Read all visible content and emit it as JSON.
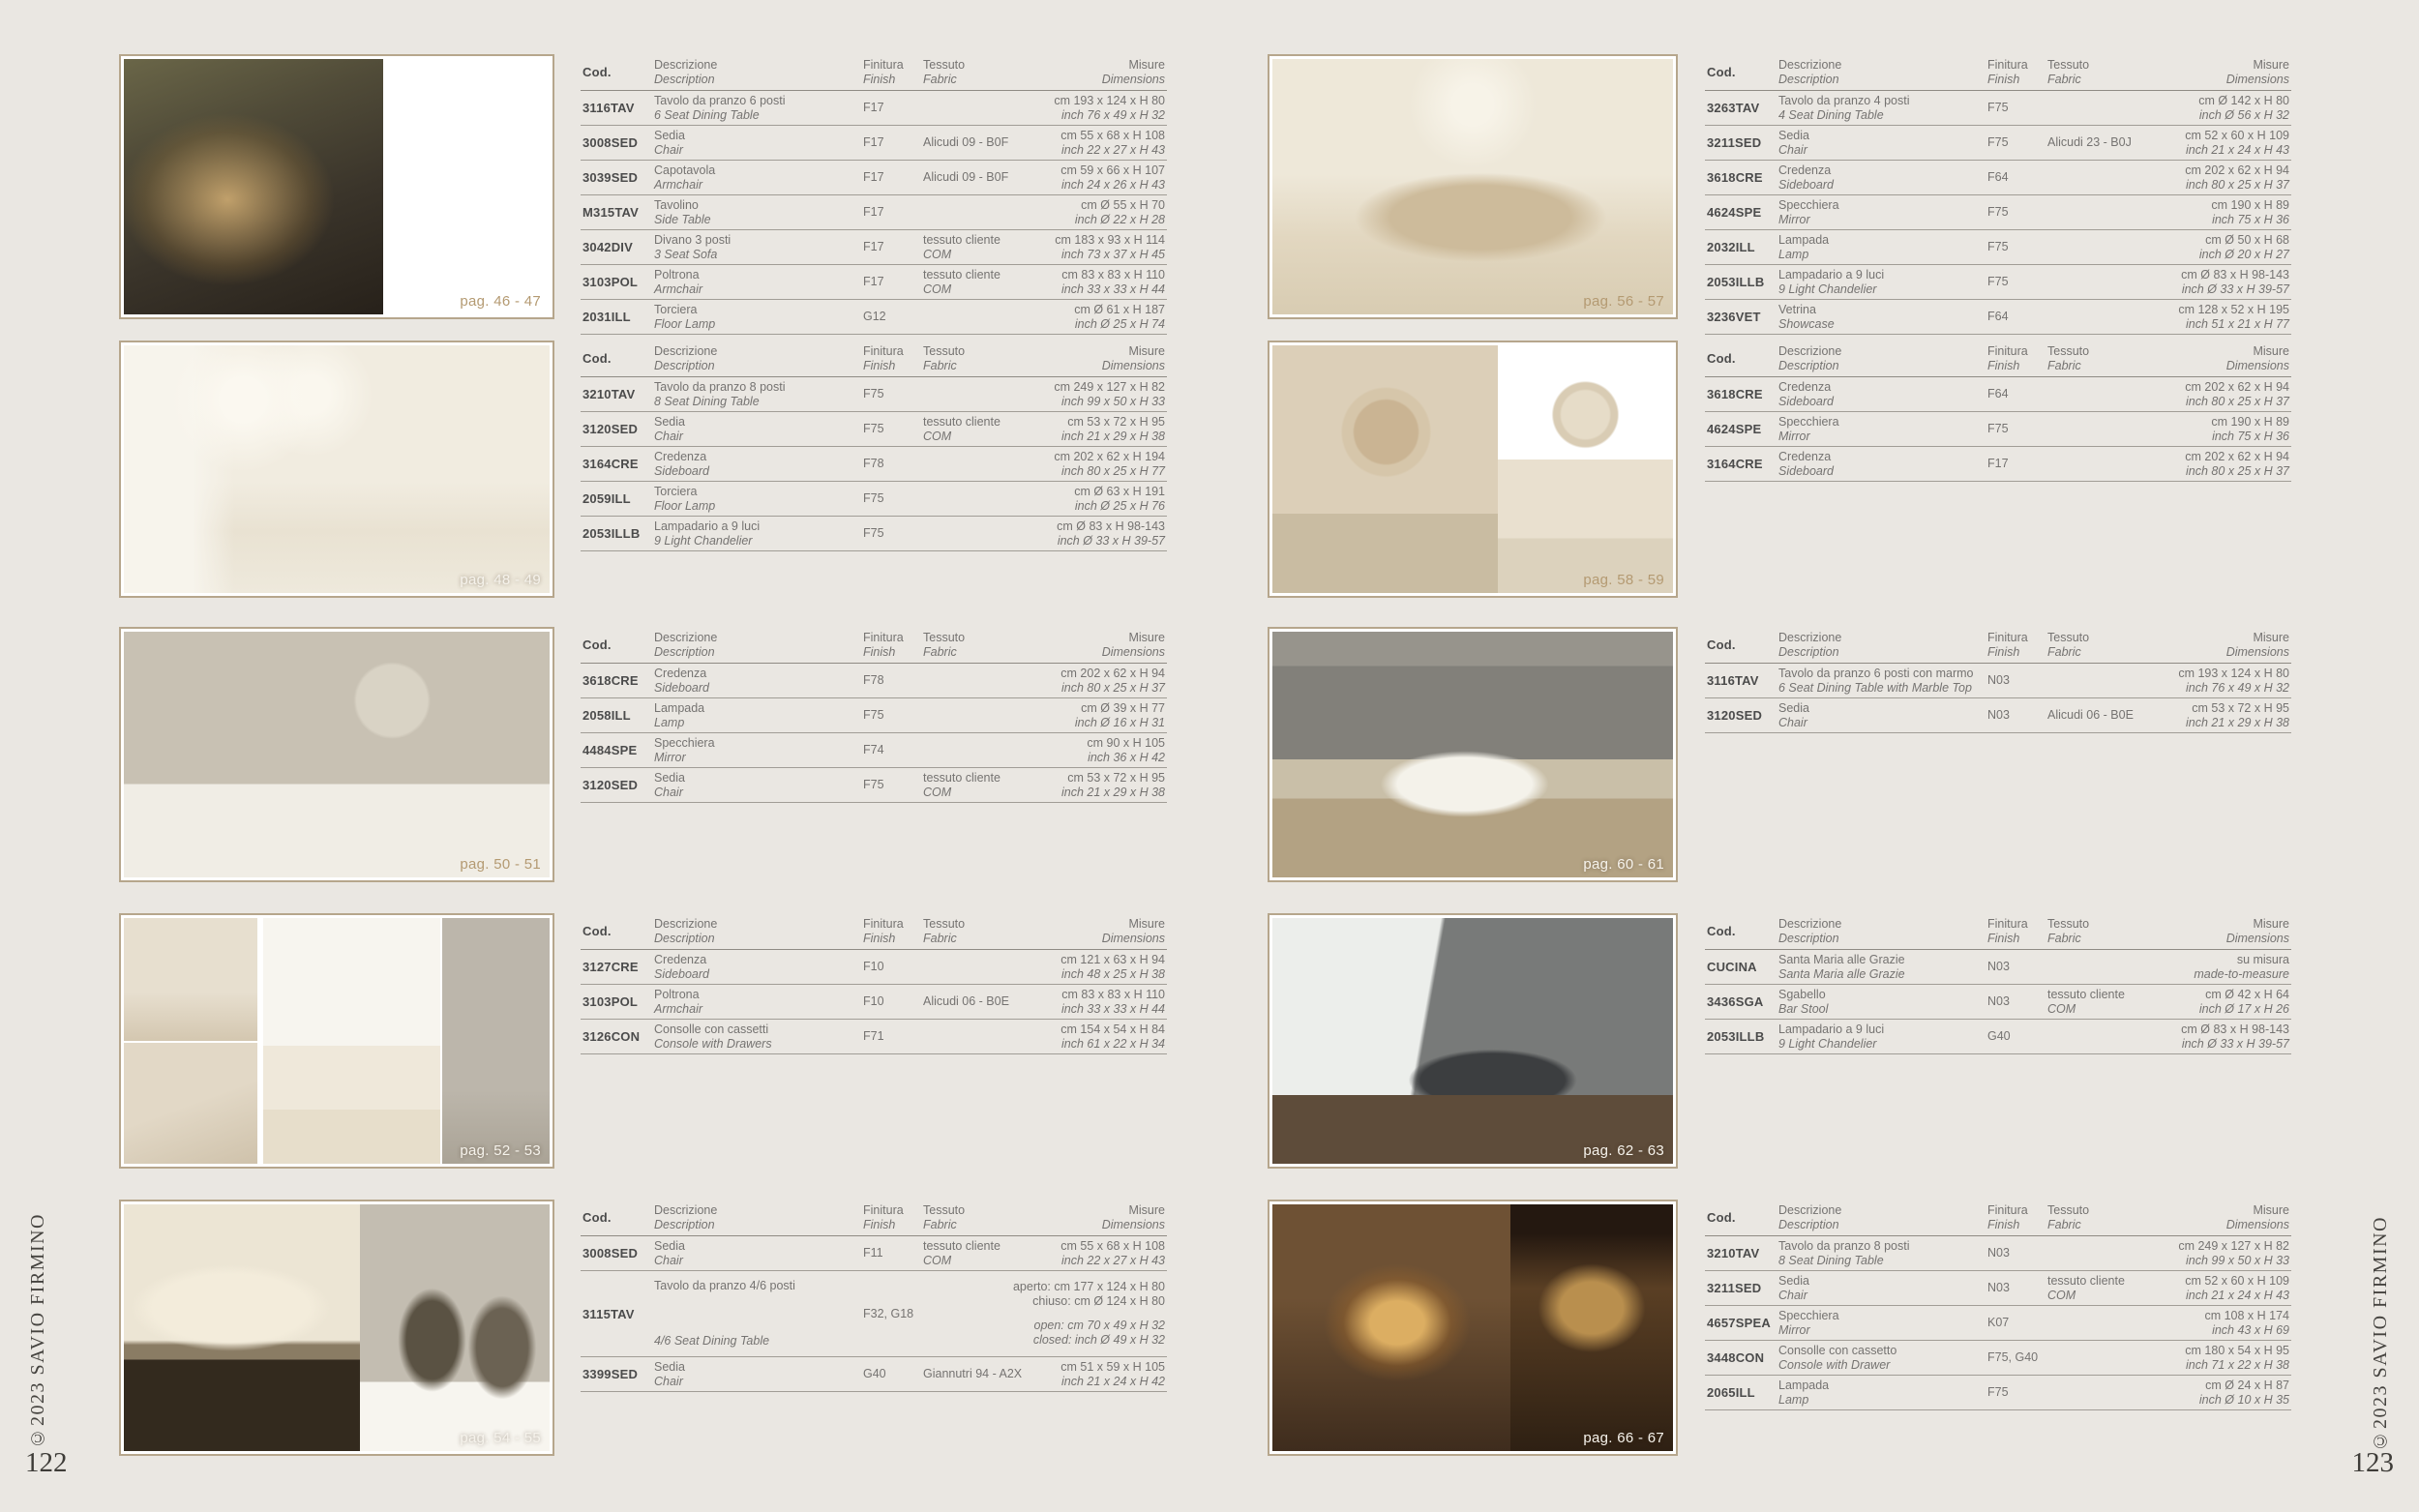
{
  "colors": {
    "page_bg": "#eae7e2",
    "accent_tan": "#b49a72",
    "table_text": "#757371",
    "code_text": "#4b4b4b",
    "divider": "#a19d96",
    "photo_border": "#b6a68c"
  },
  "table_headers": {
    "code": "Cod.",
    "desc_it": "Descrizione",
    "desc_en": "Description",
    "fin_it": "Finitura",
    "fin_en": "Finish",
    "fab_it": "Tessuto",
    "fab_en": "Fabric",
    "mis_it": "Misure",
    "mis_en": "Dimensions"
  },
  "left_page": {
    "page_number": "122",
    "copyright": "©2023 SAVIO FIRMINO",
    "photo_labels": [
      "pag. 46 - 47",
      "pag. 48 - 49",
      "pag. 50 - 51",
      "pag. 52 - 53",
      "pag. 54 - 55"
    ],
    "tables": [
      {
        "rows": [
          {
            "code": "3116TAV",
            "desc_it": "Tavolo da pranzo 6 posti",
            "desc_en": "6 Seat Dining Table",
            "finish": "F17",
            "fabric": null,
            "dims_plain": [
              "cm 193 x 124 x H 80"
            ],
            "dims_italic": [
              "inch 76 x 49 x H 32"
            ]
          },
          {
            "code": "3008SED",
            "desc_it": "Sedia",
            "desc_en": "Chair",
            "finish": "F17",
            "fabric": {
              "l1": "Alicudi 09 - B0F"
            },
            "dims_plain": [
              "cm 55 x 68 x H 108"
            ],
            "dims_italic": [
              "inch 22 x 27 x H 43"
            ]
          },
          {
            "code": "3039SED",
            "desc_it": "Capotavola",
            "desc_en": "Armchair",
            "finish": "F17",
            "fabric": {
              "l1": "Alicudi 09 - B0F"
            },
            "dims_plain": [
              "cm 59 x 66 x H 107"
            ],
            "dims_italic": [
              "inch 24 x 26 x H 43"
            ]
          },
          {
            "code": "M315TAV",
            "desc_it": "Tavolino",
            "desc_en": "Side Table",
            "finish": "F17",
            "fabric": null,
            "dims_plain": [
              "cm Ø 55 x H 70"
            ],
            "dims_italic": [
              "inch Ø 22 x H 28"
            ]
          },
          {
            "code": "3042DIV",
            "desc_it": "Divano 3 posti",
            "desc_en": "3 Seat Sofa",
            "finish": "F17",
            "fabric": {
              "l1": "tessuto cliente",
              "l2": "COM"
            },
            "dims_plain": [
              "cm 183 x 93 x H 114"
            ],
            "dims_italic": [
              "inch 73 x 37 x H 45"
            ]
          },
          {
            "code": "3103POL",
            "desc_it": "Poltrona",
            "desc_en": "Armchair",
            "finish": "F17",
            "fabric": {
              "l1": "tessuto cliente",
              "l2": "COM"
            },
            "dims_plain": [
              "cm 83 x 83 x H 110"
            ],
            "dims_italic": [
              "inch 33 x 33 x H 44"
            ]
          },
          {
            "code": "2031ILL",
            "desc_it": "Torciera",
            "desc_en": "Floor Lamp",
            "finish": "G12",
            "fabric": null,
            "dims_plain": [
              "cm Ø 61 x H 187"
            ],
            "dims_italic": [
              "inch Ø 25 x H 74"
            ]
          }
        ]
      },
      {
        "rows": [
          {
            "code": "3210TAV",
            "desc_it": "Tavolo da pranzo 8 posti",
            "desc_en": "8 Seat Dining Table",
            "finish": "F75",
            "fabric": null,
            "dims_plain": [
              "cm 249 x 127 x H 82"
            ],
            "dims_italic": [
              "inch 99 x 50 x H 33"
            ]
          },
          {
            "code": "3120SED",
            "desc_it": "Sedia",
            "desc_en": "Chair",
            "finish": "F75",
            "fabric": {
              "l1": "tessuto cliente",
              "l2": "COM"
            },
            "dims_plain": [
              "cm 53 x 72 x H 95"
            ],
            "dims_italic": [
              "inch 21 x 29 x H 38"
            ]
          },
          {
            "code": "3164CRE",
            "desc_it": "Credenza",
            "desc_en": "Sideboard",
            "finish": "F78",
            "fabric": null,
            "dims_plain": [
              "cm 202 x 62 x H 194"
            ],
            "dims_italic": [
              "inch 80 x 25 x H 77"
            ]
          },
          {
            "code": "2059ILL",
            "desc_it": "Torciera",
            "desc_en": "Floor Lamp",
            "finish": "F75",
            "fabric": null,
            "dims_plain": [
              "cm Ø 63 x H 191"
            ],
            "dims_italic": [
              "inch Ø 25 x H 76"
            ]
          },
          {
            "code": "2053ILLB",
            "desc_it": "Lampadario a 9 luci",
            "desc_en": "9 Light Chandelier",
            "finish": "F75",
            "fabric": null,
            "dims_plain": [
              "cm Ø 83 x H 98-143"
            ],
            "dims_italic": [
              "inch Ø 33 x H 39-57"
            ]
          }
        ]
      },
      {
        "rows": [
          {
            "code": "3618CRE",
            "desc_it": "Credenza",
            "desc_en": "Sideboard",
            "finish": "F78",
            "fabric": null,
            "dims_plain": [
              "cm 202 x 62 x H 94"
            ],
            "dims_italic": [
              "inch 80 x 25 x H 37"
            ]
          },
          {
            "code": "2058ILL",
            "desc_it": "Lampada",
            "desc_en": "Lamp",
            "finish": "F75",
            "fabric": null,
            "dims_plain": [
              "cm Ø 39 x H 77"
            ],
            "dims_italic": [
              "inch Ø 16 x H 31"
            ]
          },
          {
            "code": "4484SPE",
            "desc_it": "Specchiera",
            "desc_en": "Mirror",
            "finish": "F74",
            "fabric": null,
            "dims_plain": [
              "cm 90 x H 105"
            ],
            "dims_italic": [
              "inch 36 x H 42"
            ]
          },
          {
            "code": "3120SED",
            "desc_it": "Sedia",
            "desc_en": "Chair",
            "finish": "F75",
            "fabric": {
              "l1": "tessuto cliente",
              "l2": "COM"
            },
            "dims_plain": [
              "cm 53 x 72 x H 95"
            ],
            "dims_italic": [
              "inch 21 x 29 x H 38"
            ]
          }
        ]
      },
      {
        "rows": [
          {
            "code": "3127CRE",
            "desc_it": "Credenza",
            "desc_en": "Sideboard",
            "finish": "F10",
            "fabric": null,
            "dims_plain": [
              "cm 121 x 63 x H 94"
            ],
            "dims_italic": [
              "inch 48 x 25 x H 38"
            ]
          },
          {
            "code": "3103POL",
            "desc_it": "Poltrona",
            "desc_en": "Armchair",
            "finish": "F10",
            "fabric": {
              "l1": "Alicudi 06 - B0E"
            },
            "dims_plain": [
              "cm 83 x 83 x H 110"
            ],
            "dims_italic": [
              "inch 33 x 33 x H 44"
            ]
          },
          {
            "code": "3126CON",
            "desc_it": "Consolle con cassetti",
            "desc_en": "Console with Drawers",
            "finish": "F71",
            "fabric": null,
            "dims_plain": [
              "cm 154 x 54 x H 84"
            ],
            "dims_italic": [
              "inch 61 x 22 x H 34"
            ]
          }
        ]
      },
      {
        "rows": [
          {
            "code": "3008SED",
            "desc_it": "Sedia",
            "desc_en": "Chair",
            "finish": "F11",
            "fabric": {
              "l1": "tessuto cliente",
              "l2": "COM"
            },
            "dims_plain": [
              "cm 55 x 68 x H 108"
            ],
            "dims_italic": [
              "inch 22 x 27 x H 43"
            ]
          },
          {
            "code": "3115TAV",
            "tall": true,
            "desc_it": "Tavolo da pranzo 4/6 posti",
            "desc_en": "4/6 Seat Dining Table",
            "finish": "F32, G18",
            "fabric": null,
            "dims_plain": [
              "aperto: cm 177 x 124 x H 80",
              "chiuso: cm Ø 124 x H 80"
            ],
            "dims_italic": [
              "open: cm 70 x 49 x H 32",
              "closed: inch Ø 49 x H 32"
            ]
          },
          {
            "code": "3399SED",
            "desc_it": "Sedia",
            "desc_en": "Chair",
            "finish": "G40",
            "fabric": {
              "l1": "Giannutri 94 - A2X"
            },
            "dims_plain": [
              "cm 51 x 59 x H 105"
            ],
            "dims_italic": [
              "inch 21 x 24 x H 42"
            ]
          }
        ]
      }
    ]
  },
  "right_page": {
    "page_number": "123",
    "copyright": "©2023 SAVIO FIRMINO",
    "photo_labels": [
      "pag. 56 - 57",
      "pag. 58 - 59",
      "pag. 60 - 61",
      "pag. 62 - 63",
      "pag. 66 - 67"
    ],
    "tables": [
      {
        "rows": [
          {
            "code": "3263TAV",
            "desc_it": "Tavolo da pranzo 4 posti",
            "desc_en": "4 Seat Dining Table",
            "finish": "F75",
            "fabric": null,
            "dims_plain": [
              "cm Ø 142 x H 80"
            ],
            "dims_italic": [
              "inch Ø 56 x H 32"
            ]
          },
          {
            "code": "3211SED",
            "desc_it": "Sedia",
            "desc_en": "Chair",
            "finish": "F75",
            "fabric": {
              "l1": "Alicudi 23 - B0J"
            },
            "dims_plain": [
              "cm 52 x 60 x H 109"
            ],
            "dims_italic": [
              "inch 21 x 24 x H 43"
            ]
          },
          {
            "code": "3618CRE",
            "desc_it": "Credenza",
            "desc_en": "Sideboard",
            "finish": "F64",
            "fabric": null,
            "dims_plain": [
              "cm 202 x 62 x H 94"
            ],
            "dims_italic": [
              "inch 80 x 25 x H 37"
            ]
          },
          {
            "code": "4624SPE",
            "desc_it": "Specchiera",
            "desc_en": "Mirror",
            "finish": "F75",
            "fabric": null,
            "dims_plain": [
              "cm 190 x H 89"
            ],
            "dims_italic": [
              "inch 75 x H 36"
            ]
          },
          {
            "code": "2032ILL",
            "desc_it": "Lampada",
            "desc_en": "Lamp",
            "finish": "F75",
            "fabric": null,
            "dims_plain": [
              "cm Ø 50 x H 68"
            ],
            "dims_italic": [
              "inch Ø 20 x H 27"
            ]
          },
          {
            "code": "2053ILLB",
            "desc_it": "Lampadario a 9 luci",
            "desc_en": "9 Light Chandelier",
            "finish": "F75",
            "fabric": null,
            "dims_plain": [
              "cm Ø 83 x H 98-143"
            ],
            "dims_italic": [
              "inch Ø 33 x H 39-57"
            ]
          },
          {
            "code": "3236VET",
            "desc_it": "Vetrina",
            "desc_en": "Showcase",
            "finish": "F64",
            "fabric": null,
            "dims_plain": [
              "cm 128 x 52 x H 195"
            ],
            "dims_italic": [
              "inch 51 x 21 x H 77"
            ]
          }
        ]
      },
      {
        "rows": [
          {
            "code": "3618CRE",
            "desc_it": "Credenza",
            "desc_en": "Sideboard",
            "finish": "F64",
            "fabric": null,
            "dims_plain": [
              "cm 202 x 62 x H 94"
            ],
            "dims_italic": [
              "inch 80 x 25 x H 37"
            ]
          },
          {
            "code": "4624SPE",
            "desc_it": "Specchiera",
            "desc_en": "Mirror",
            "finish": "F75",
            "fabric": null,
            "dims_plain": [
              "cm 190 x H 89"
            ],
            "dims_italic": [
              "inch 75 x H 36"
            ]
          },
          {
            "code": "3164CRE",
            "desc_it": "Credenza",
            "desc_en": "Sideboard",
            "finish": "F17",
            "fabric": null,
            "dims_plain": [
              "cm 202 x 62 x H 94"
            ],
            "dims_italic": [
              "inch 80 x 25 x H 37"
            ]
          }
        ]
      },
      {
        "rows": [
          {
            "code": "3116TAV",
            "desc_it": "Tavolo da pranzo 6 posti con marmo",
            "desc_en": "6 Seat Dining Table with Marble Top",
            "finish": "N03",
            "fabric": null,
            "dims_plain": [
              "cm 193 x 124 x H 80"
            ],
            "dims_italic": [
              "inch 76 x 49 x H 32"
            ]
          },
          {
            "code": "3120SED",
            "desc_it": "Sedia",
            "desc_en": "Chair",
            "finish": "N03",
            "fabric": {
              "l1": "Alicudi 06 - B0E"
            },
            "dims_plain": [
              "cm 53 x 72 x H 95"
            ],
            "dims_italic": [
              "inch 21 x 29 x H 38"
            ]
          }
        ]
      },
      {
        "rows": [
          {
            "code": "CUCINA",
            "desc_it": "Santa Maria alle Grazie",
            "desc_en": "Santa Maria alle Grazie",
            "finish": "N03",
            "fabric": null,
            "dims_plain": [
              "su misura"
            ],
            "dims_italic": [
              "made-to-measure"
            ]
          },
          {
            "code": "3436SGA",
            "desc_it": "Sgabello",
            "desc_en": "Bar Stool",
            "finish": "N03",
            "fabric": {
              "l1": "tessuto cliente",
              "l2": "COM"
            },
            "dims_plain": [
              "cm Ø 42 x H 64"
            ],
            "dims_italic": [
              "inch Ø 17 x H 26"
            ]
          },
          {
            "code": "2053ILLB",
            "desc_it": "Lampadario a 9 luci",
            "desc_en": "9 Light Chandelier",
            "finish": "G40",
            "fabric": null,
            "dims_plain": [
              "cm Ø 83 x H 98-143"
            ],
            "dims_italic": [
              "inch Ø 33 x H 39-57"
            ]
          }
        ]
      },
      {
        "rows": [
          {
            "code": "3210TAV",
            "desc_it": "Tavolo da pranzo 8 posti",
            "desc_en": "8 Seat Dining Table",
            "finish": "N03",
            "fabric": null,
            "dims_plain": [
              "cm 249 x 127 x H 82"
            ],
            "dims_italic": [
              "inch 99 x 50 x H 33"
            ]
          },
          {
            "code": "3211SED",
            "desc_it": "Sedia",
            "desc_en": "Chair",
            "finish": "N03",
            "fabric": {
              "l1": "tessuto cliente",
              "l2": "COM"
            },
            "dims_plain": [
              "cm 52 x 60 x H 109"
            ],
            "dims_italic": [
              "inch 21 x 24 x H 43"
            ]
          },
          {
            "code": "4657SPEA",
            "desc_it": "Specchiera",
            "desc_en": "Mirror",
            "finish": "K07",
            "fabric": null,
            "dims_plain": [
              "cm 108 x H 174"
            ],
            "dims_italic": [
              "inch 43 x H 69"
            ]
          },
          {
            "code": "3448CON",
            "desc_it": "Consolle con cassetto",
            "desc_en": "Console with Drawer",
            "finish": "F75, G40",
            "fabric": null,
            "dims_plain": [
              "cm 180 x 54 x H 95"
            ],
            "dims_italic": [
              "inch 71 x 22 x H 38"
            ]
          },
          {
            "code": "2065ILL",
            "desc_it": "Lampada",
            "desc_en": "Lamp",
            "finish": "F75",
            "fabric": null,
            "dims_plain": [
              "cm Ø 24 x H 87"
            ],
            "dims_italic": [
              "inch Ø 10 x H 35"
            ]
          }
        ]
      }
    ]
  }
}
